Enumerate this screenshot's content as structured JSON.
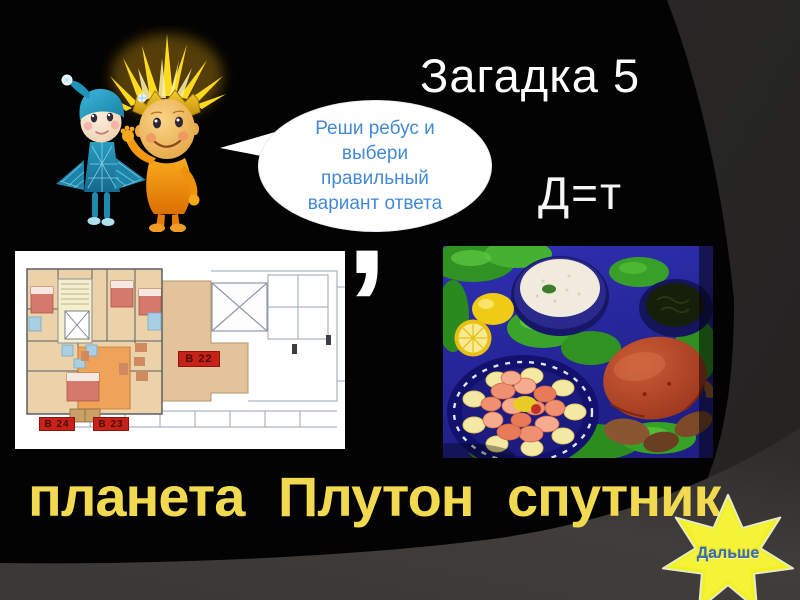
{
  "title": "Загадка 5",
  "speech_bubble": {
    "lines": [
      "Реши ребус и",
      "выбери",
      "правильный",
      "вариант ответа"
    ]
  },
  "substitution_hint": "Д=т",
  "rebus": {
    "comma": ",",
    "floor_plan_labels": {
      "b22": "В 22",
      "b24": "В 24",
      "b23": "В 23"
    }
  },
  "answers": [
    "планета",
    "Плутон",
    "спутник"
  ],
  "next_button": "Дальше",
  "colors": {
    "title_text": "#fdfdfd",
    "bubble_text": "#4489d4",
    "answer_text": "#f2da50",
    "star_fill": "#f2f01f",
    "star_label": "#3a6cb2",
    "plan_label_bg": "#c6221a",
    "slide_black": "#030303",
    "slide_gray": "#3b3a39"
  }
}
